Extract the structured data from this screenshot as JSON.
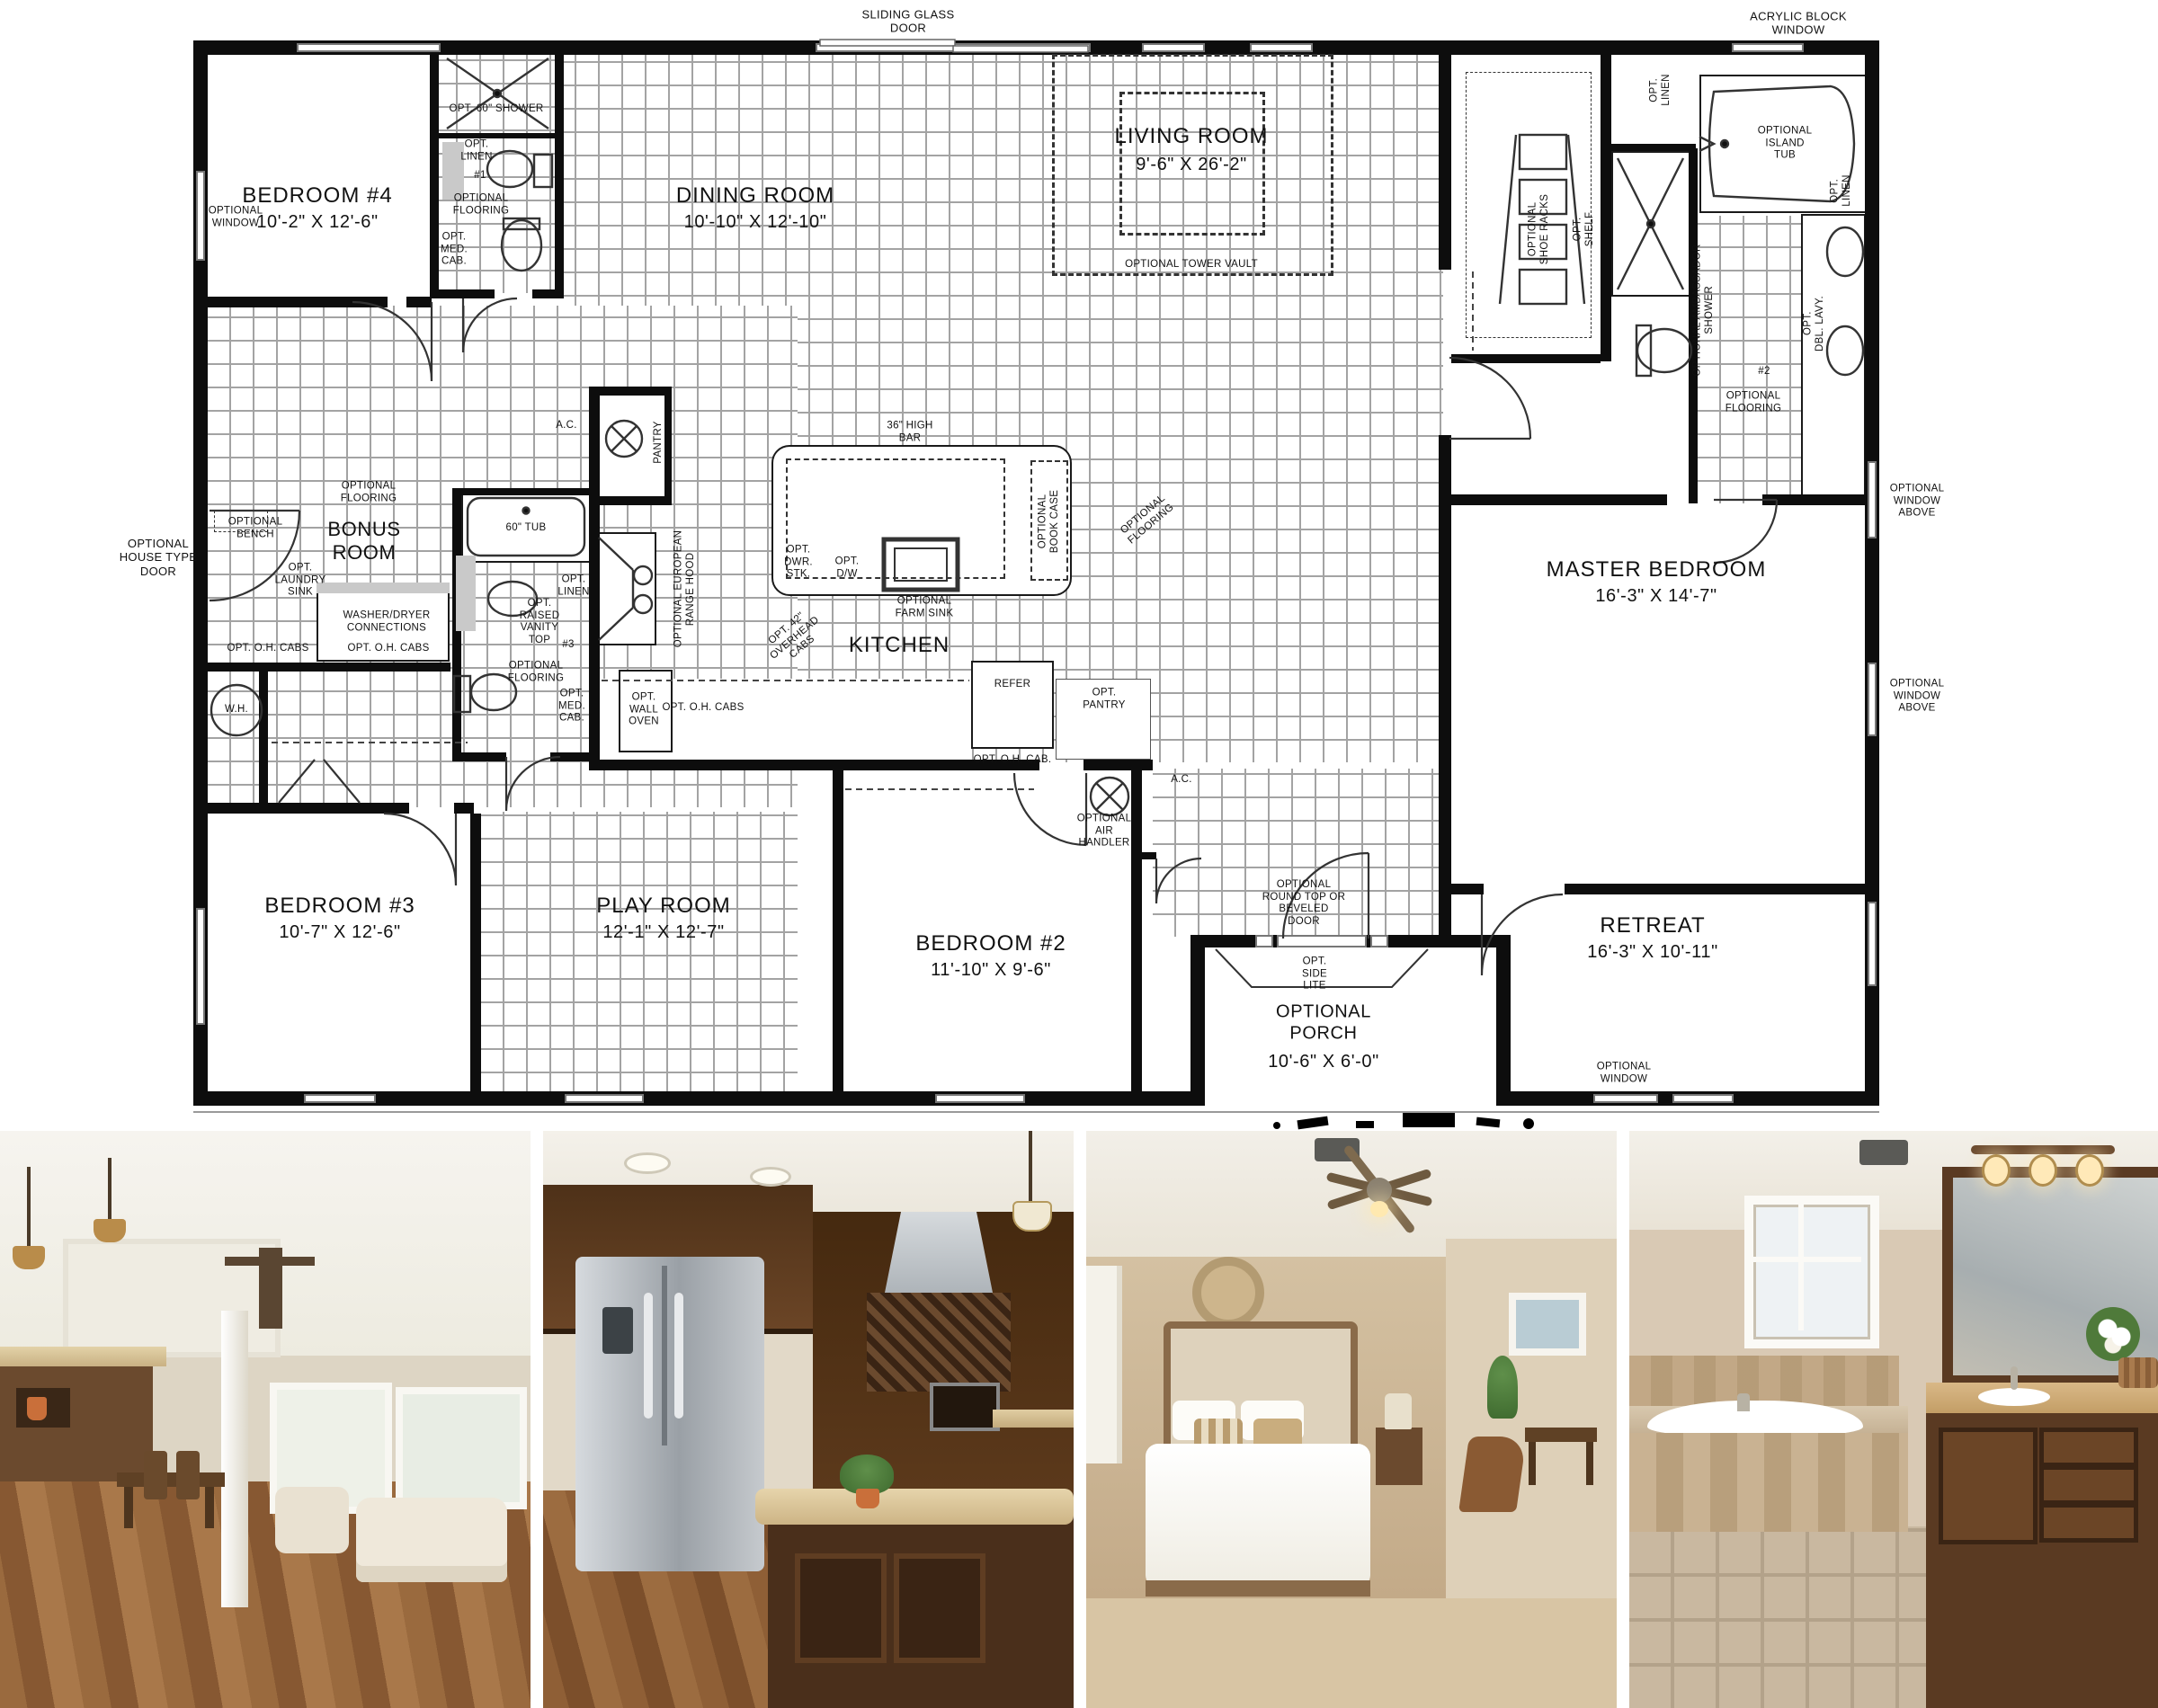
{
  "floor_plan": {
    "rooms": {
      "bedroom4": {
        "name": "BEDROOM #4",
        "dims": "10'-2\" X 12'-6\""
      },
      "dining": {
        "name": "DINING ROOM",
        "dims": "10'-10\" X 12'-10\""
      },
      "living": {
        "name": "LIVING ROOM",
        "dims": "9'-6\" X 26'-2\""
      },
      "master": {
        "name": "MASTER BEDROOM",
        "dims": "16'-3\" X 14'-7\""
      },
      "bonus": {
        "name": "BONUS\nROOM"
      },
      "kitchen": {
        "name": "KITCHEN"
      },
      "bedroom3": {
        "name": "BEDROOM #3",
        "dims": "10'-7\" X 12'-6\""
      },
      "play": {
        "name": "PLAY ROOM",
        "dims": "12'-1\" X 12'-7\""
      },
      "bedroom2": {
        "name": "BEDROOM #2",
        "dims": "11'-10\" X 9'-6\""
      },
      "retreat": {
        "name": "RETREAT",
        "dims": "16'-3\" X 10'-11\""
      },
      "porch": {
        "name": "OPTIONAL\nPORCH",
        "dims": "10'-6\" X 6'-0\""
      }
    },
    "exterior": {
      "sliding_glass_door": "SLIDING GLASS\nDOOR",
      "acrylic_block_window": "ACRYLIC BLOCK\nWINDOW",
      "optional_window": "OPTIONAL\nWINDOW",
      "optional_window_above": "OPTIONAL\nWINDOW\nABOVE",
      "optional_house_type_door": "OPTIONAL\nHOUSE TYPE\nDOOR",
      "optional_round_top_door": "OPTIONAL\nROUND TOP OR\nBEVELED\nDOOR",
      "opt_side_lite": "OPT.\nSIDE\nLITE"
    },
    "features": {
      "opt_60_shower": "OPT. 60\" SHOWER",
      "opt_linen": "OPT.\nLINEN",
      "bath1_no": "#1",
      "bath2_no": "#2",
      "bath3_no": "#3",
      "optional_flooring": "OPTIONAL\nFLOORING",
      "opt_med_cab": "OPT.\nMED.\nCAB.",
      "optional_tower_vault": "OPTIONAL TOWER VAULT",
      "optional_island_tub": "OPTIONAL\nISLAND\nTUB",
      "optional_shoe_racks": "OPTIONAL\nSHOE RACKS",
      "opt_shelf": "OPT.\nSHELF",
      "optional_ambassador_shower": "OPTIONAL AMBASSADOR\nSHOWER",
      "opt_dbl_lavy": "OPT.\nDBL. LAVY.",
      "optional_bench": "OPTIONAL\nBENCH",
      "opt_laundry_sink": "OPT.\nLAUNDRY\nSINK",
      "washer_dryer": "WASHER/DRYER\nCONNECTIONS",
      "opt_oh_cabs": "OPT. O.H. CABS",
      "opt_oh_cab": "OPT. O.H. CAB.",
      "wh": "W.H.",
      "tub_60": "60\" TUB",
      "opt_raised_vanity_top": "OPT.\nRAISED\nVANITY\nTOP",
      "ac": "A.C.",
      "pantry": "PANTRY",
      "optional_european_range_hood": "OPTIONAL EUROPEAN\nRANGE HOOD",
      "opt_wall_oven": "OPT.\nWALL\nOVEN",
      "high_bar_36": "36\" HIGH\nBAR",
      "opt_dwr_stk": "OPT.\nDWR.\nSTK.",
      "opt_dw": "OPT.\nD/W",
      "optional_farm_sink": "OPTIONAL\nFARM SINK",
      "optional_book_case": "OPTIONAL\nBOOK CASE",
      "opt_42_overhead_cabs": "OPT. 42\"\nOVERHEAD\nCABS",
      "refer": "REFER",
      "opt_pantry": "OPT.\nPANTRY",
      "optional_air_handler": "OPTIONAL\nAIR\nHANDLER"
    }
  },
  "photos": [
    {
      "name": "living-dining-room-photo"
    },
    {
      "name": "kitchen-photo"
    },
    {
      "name": "master-bedroom-photo"
    },
    {
      "name": "master-bathroom-photo"
    }
  ],
  "colors": {
    "plan_wall": "#0d0d0d",
    "tile_line": "#a3a3a3",
    "wood_floor": "#9a6a3e",
    "cabinet_wood": "#53351d",
    "granite": "#d8c49a",
    "stainless": "#c0c4c8",
    "wall_tan": "#cbb393",
    "carpet": "#d8c5a4"
  }
}
